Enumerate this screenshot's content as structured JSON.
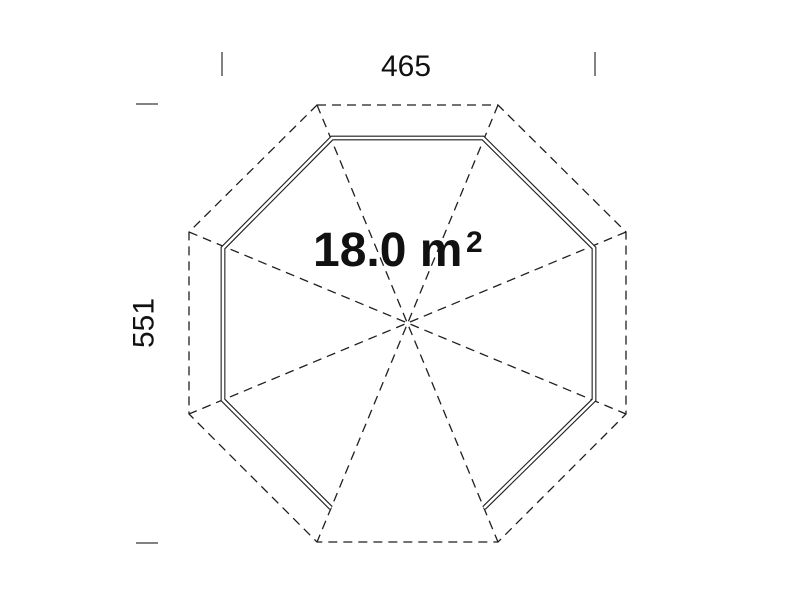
{
  "floor_plan": {
    "area_value": "18.0 m",
    "area_superscript": "2",
    "width_label": "465",
    "height_label": "551",
    "colors": {
      "line": "#1f1f1f",
      "tick": "#828282",
      "text": "#111111",
      "background": "#ffffff"
    }
  }
}
